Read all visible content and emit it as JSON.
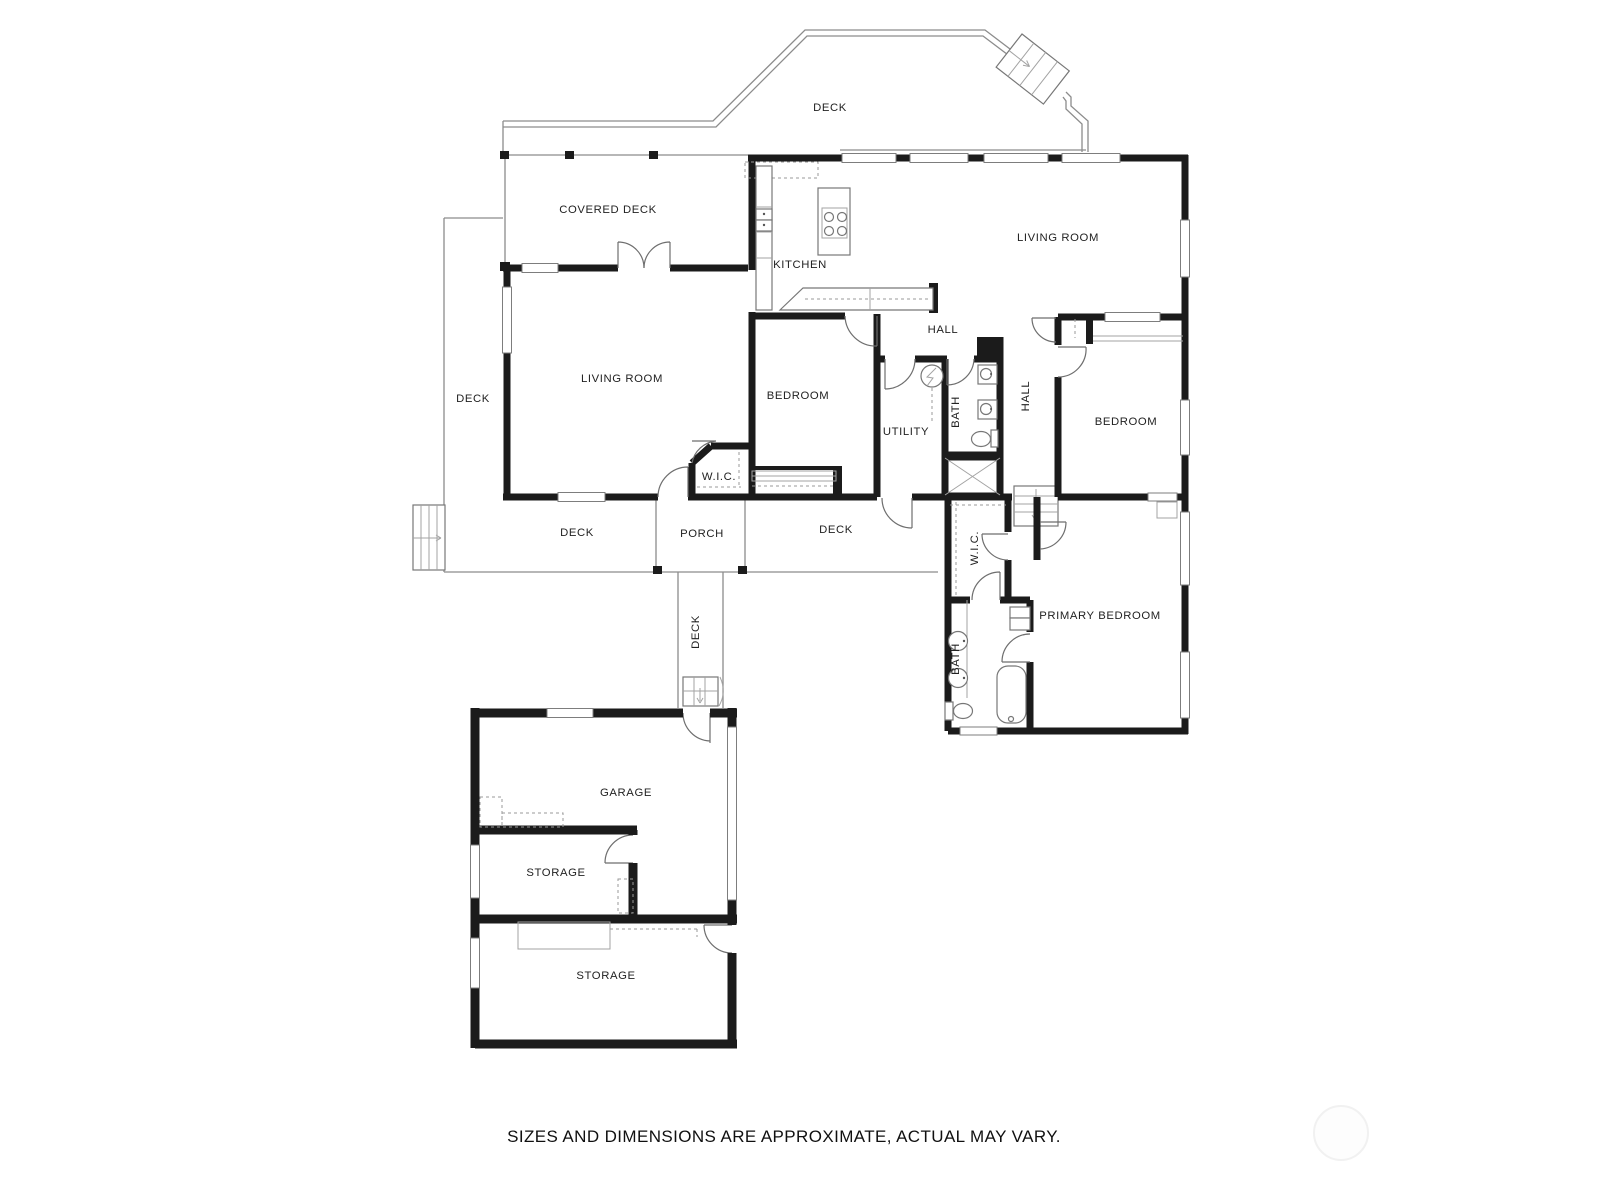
{
  "plan": {
    "type": "residential-floor-plan",
    "colors": {
      "wall": "#1b1b1b",
      "line": "#8c8c8c",
      "text": "#222222",
      "background": "#ffffff"
    },
    "disclaimer": "SIZES AND DIMENSIONS ARE APPROXIMATE, ACTUAL MAY VARY.",
    "labels": [
      {
        "id": "deck-top",
        "text": "DECK"
      },
      {
        "id": "covered-deck",
        "text": "COVERED DECK"
      },
      {
        "id": "kitchen",
        "text": "KITCHEN"
      },
      {
        "id": "living-room-upper",
        "text": "LIVING ROOM"
      },
      {
        "id": "living-room-left",
        "text": "LIVING ROOM"
      },
      {
        "id": "deck-left",
        "text": "DECK"
      },
      {
        "id": "bedroom-middle",
        "text": "BEDROOM"
      },
      {
        "id": "utility",
        "text": "UTILITY"
      },
      {
        "id": "bath-middle",
        "text": "BATH"
      },
      {
        "id": "hall-upper",
        "text": "HALL"
      },
      {
        "id": "hall-middle",
        "text": "HALL"
      },
      {
        "id": "bedroom-right",
        "text": "BEDROOM"
      },
      {
        "id": "wic-left",
        "text": "W.I.C."
      },
      {
        "id": "deck-bottom-left",
        "text": "DECK"
      },
      {
        "id": "porch",
        "text": "PORCH"
      },
      {
        "id": "deck-bottom-mid",
        "text": "DECK"
      },
      {
        "id": "wic-primary",
        "text": "W.I.C."
      },
      {
        "id": "primary-bedroom",
        "text": "PRIMARY BEDROOM"
      },
      {
        "id": "bath-primary",
        "text": "BATH"
      },
      {
        "id": "deck-walkway",
        "text": "DECK"
      },
      {
        "id": "garage",
        "text": "GARAGE"
      },
      {
        "id": "storage-upper",
        "text": "STORAGE"
      },
      {
        "id": "storage-lower",
        "text": "STORAGE"
      }
    ]
  }
}
